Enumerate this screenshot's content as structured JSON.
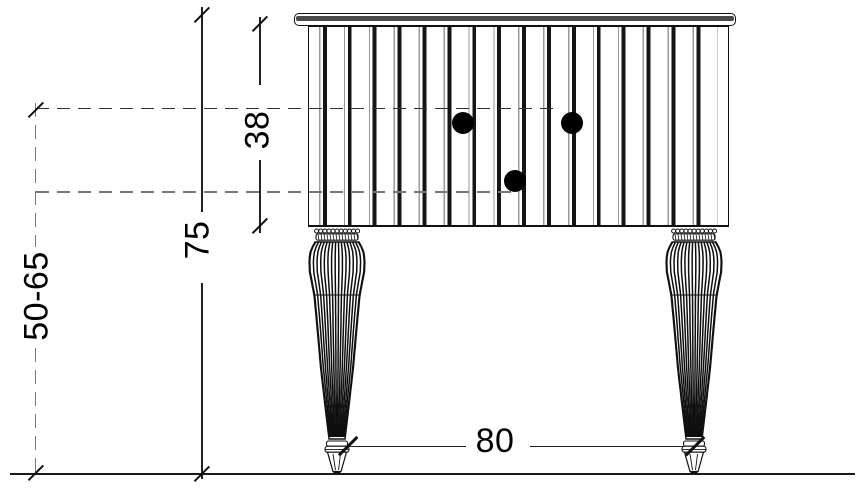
{
  "drawing": {
    "dimensions": {
      "total_height": "75",
      "cabinet_height": "38",
      "height_range": "50-65",
      "width": "80"
    },
    "colors": {
      "line": "#1a1a1a",
      "dashed_gray": "#777777",
      "knob": "#000000",
      "background": "#ffffff"
    }
  }
}
